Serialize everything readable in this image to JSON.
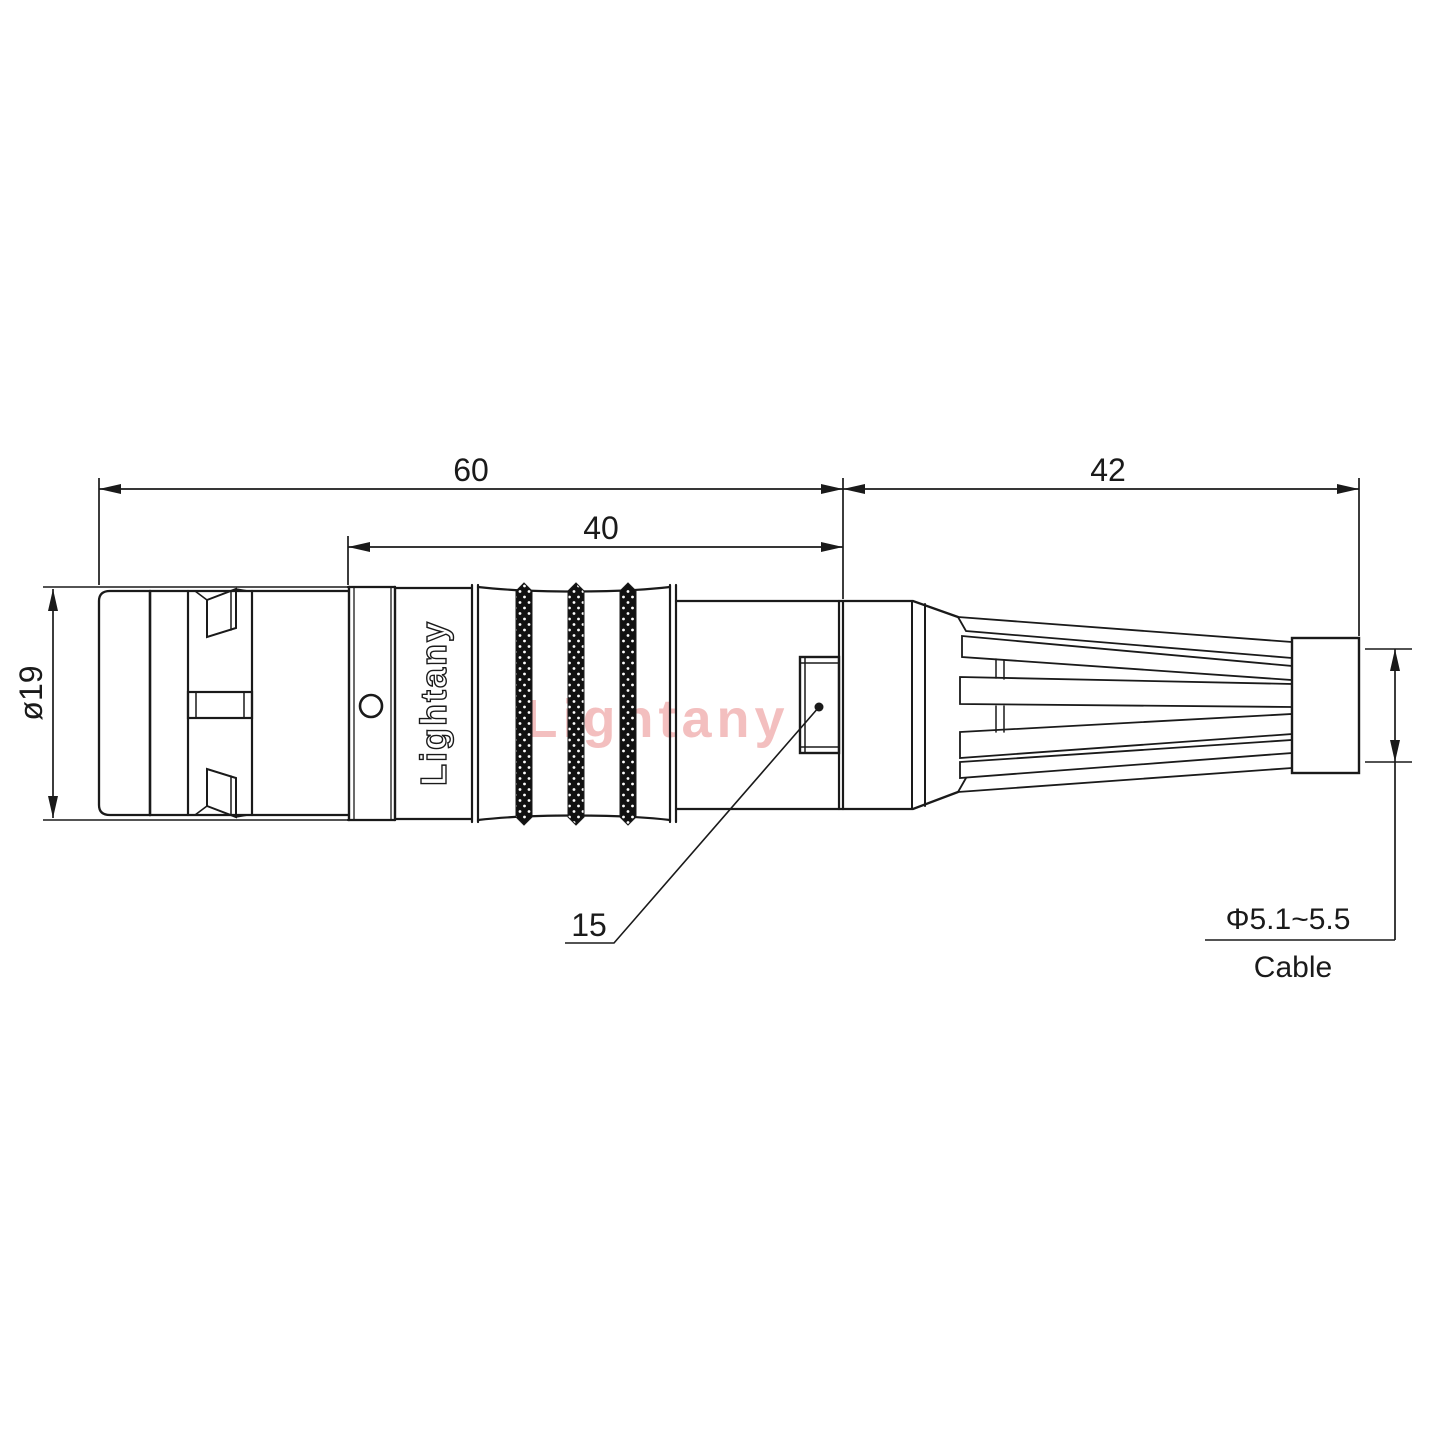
{
  "drawing": {
    "type": "connector-technical-drawing",
    "bg_color": "#ffffff",
    "line_color": "#1a1a1a",
    "watermark": {
      "text": "Lightany",
      "color": "#f2b9b9"
    },
    "logo": {
      "body_text": "Lightany"
    },
    "dims": {
      "total": {
        "label": "60"
      },
      "inner": {
        "label": "40"
      },
      "boot": {
        "label": "42"
      },
      "diameter": {
        "label": "ø19"
      },
      "detail": {
        "label": "15"
      },
      "cable": {
        "label": "Φ5.1~5.5",
        "caption": "Cable"
      }
    }
  }
}
